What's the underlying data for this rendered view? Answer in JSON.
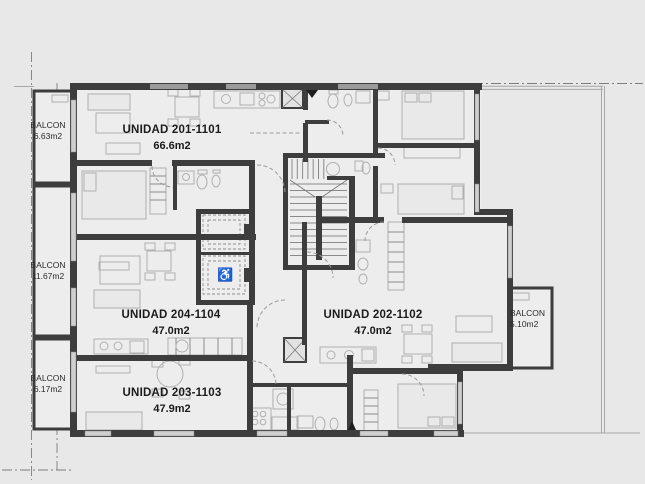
{
  "plan": {
    "type": "apartment-floor-plan",
    "units": [
      {
        "name": "UNIDAD 201-1101",
        "area": "66.6m2"
      },
      {
        "name": "UNIDAD 202-1102",
        "area": "47.0m2"
      },
      {
        "name": "UNIDAD 203-1103",
        "area": "47.9m2"
      },
      {
        "name": "UNIDAD 204-1104",
        "area": "47.0m2"
      }
    ],
    "balconies": [
      {
        "name": "BALCON",
        "area": "6.63m2"
      },
      {
        "name": "BALCON",
        "area": "11.67m2"
      },
      {
        "name": "BALCON",
        "area": "6.17m2"
      },
      {
        "name": "BALCON",
        "area": "5.10m2"
      }
    ],
    "icons": {
      "wheelchair": "♿"
    },
    "colors": {
      "background": "#e8e8e8",
      "wall": "#3d3d3d",
      "floor": "#ededed",
      "furniture": "#b0b0b0",
      "text": "#1b1b1b"
    }
  }
}
